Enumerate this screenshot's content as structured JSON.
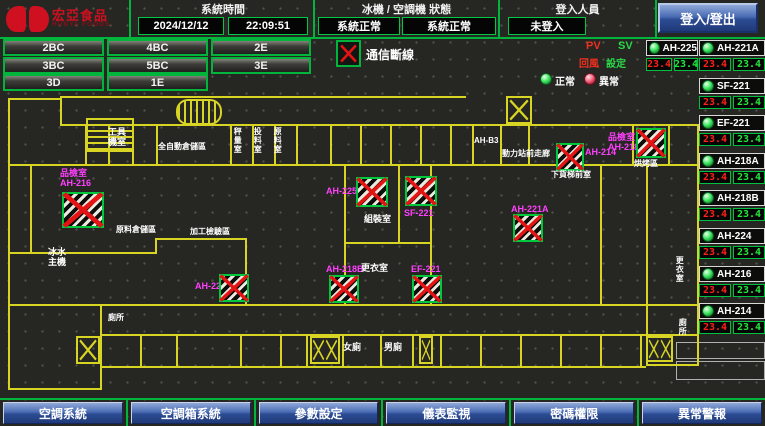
{
  "header": {
    "logo": {
      "brand": "宏亞食品",
      "brand_en": "HUNYA FOODS"
    },
    "time": {
      "label": "系統時間",
      "date": "2024/12/12",
      "time": "22:09:51"
    },
    "status": {
      "label": "冰機 / 空調機 狀態",
      "chiller": "系統正常",
      "ahu": "系統正常"
    },
    "login": {
      "label": "登入人員",
      "user": "未登入",
      "button": "登入/登出"
    }
  },
  "nav": {
    "buttons": [
      "2BC",
      "4BC",
      "2E",
      "3BC",
      "5BC",
      "3E",
      "3D",
      "1E"
    ]
  },
  "legend": {
    "comm_loss": "通信斷線",
    "pv": "PV",
    "sv": "SV",
    "pv_name": "回風",
    "sv_name": "設定",
    "normal": "正常",
    "abnormal": "異常"
  },
  "units": [
    {
      "name": "AH-225",
      "pv": "23.4",
      "sv": "23.4"
    },
    {
      "name": "AH-221A",
      "pv": "23.4",
      "sv": "23.4"
    },
    {
      "name": "SF-221",
      "pv": "23.4",
      "sv": "23.4"
    },
    {
      "name": "EF-221",
      "pv": "23.4",
      "sv": "23.4"
    },
    {
      "name": "AH-218A",
      "pv": "23.4",
      "sv": "23.4"
    },
    {
      "name": "AH-218B",
      "pv": "23.4",
      "sv": "23.4"
    },
    {
      "name": "AH-224",
      "pv": "23.4",
      "sv": "23.4"
    },
    {
      "name": "AH-216",
      "pv": "23.4",
      "sv": "23.4"
    },
    {
      "name": "AH-214",
      "pv": "23.4",
      "sv": "23.4"
    }
  ],
  "plan": {
    "rooms": [
      "工具機室",
      "全自動倉儲區",
      "秤量室",
      "投料室",
      "原料室",
      "AH-B3",
      "動力站前走廊",
      "下貨梯前室",
      "烘烤區",
      "組裝室",
      "更衣室",
      "原料倉儲區",
      "加工檢驗區",
      "冰水主機",
      "女廁",
      "男廁",
      "更衣室",
      "廁所",
      "廁所"
    ],
    "devices": [
      {
        "room": "品檢室",
        "name": "AH-216"
      },
      {
        "name": "AH-214"
      },
      {
        "room": "品檢室",
        "name": "AH-218A"
      },
      {
        "name": "AH-225"
      },
      {
        "name": "SF-221"
      },
      {
        "name": "AH-221A"
      },
      {
        "name": "AH-224"
      },
      {
        "name": "AH-218B"
      },
      {
        "name": "EF-221"
      }
    ]
  },
  "footer": {
    "buttons": [
      "空調系統",
      "空調箱系統",
      "參數設定",
      "儀表監視",
      "密碼權限",
      "異常警報"
    ]
  }
}
